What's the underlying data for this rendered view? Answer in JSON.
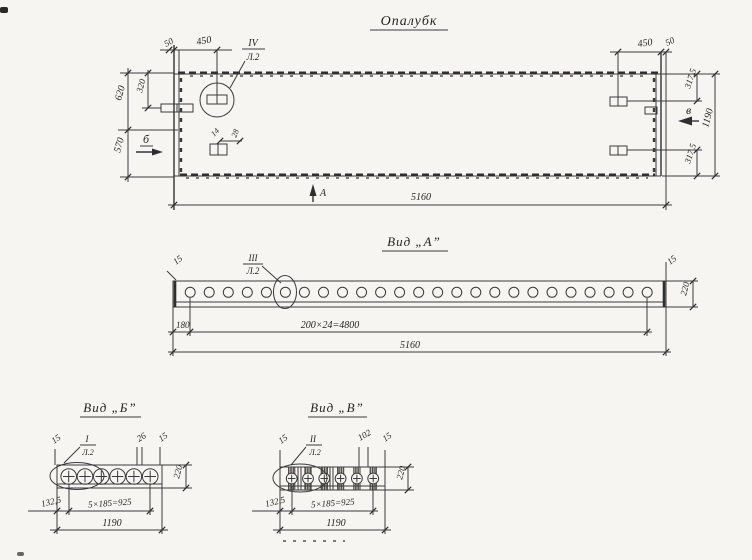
{
  "drawing": {
    "background": "#f6f5f1",
    "ink": "#333333"
  },
  "plan": {
    "title": "Опалубк",
    "callout_iv": {
      "num": "IV",
      "sheet": "Л.2"
    },
    "markers": {
      "a": "А",
      "b": "б",
      "v": "в"
    },
    "dims": {
      "d50_left": "50",
      "d450_left": "450",
      "d320": "320",
      "d620": "620",
      "d570": "570",
      "d14": "14",
      "d28": "28",
      "d450_right": "450",
      "d50_right": "50",
      "d3175_top": "317,5",
      "d1190": "1190",
      "d3175_bot": "317,5",
      "d5160": "5160"
    }
  },
  "view_a": {
    "title": "Вид „А”",
    "callout": {
      "num": "III",
      "sheet": "Л.2"
    },
    "hole_count": 25,
    "dims": {
      "d15_left": "15",
      "d180": "180",
      "spacing": "200×24=4800",
      "total": "5160",
      "d15_right": "15",
      "d220": "220"
    }
  },
  "view_b": {
    "title": "Вид „Б”",
    "callout": {
      "num": "I",
      "sheet": "Л.2"
    },
    "hole_count": 6,
    "dims": {
      "d15_left": "15",
      "d26": "26",
      "d15_right": "15",
      "d1325": "132,5",
      "spacing": "5×185=925",
      "total": "1190",
      "d220": "220"
    }
  },
  "view_v": {
    "title": "Вид „В”",
    "callout": {
      "num": "II",
      "sheet": "Л.2"
    },
    "hole_count": 6,
    "dims": {
      "d15_left": "15",
      "d102": "102",
      "d15_right": "15",
      "d1325": "132,5",
      "spacing": "5×185=925",
      "total": "1190",
      "d220": "220"
    }
  }
}
